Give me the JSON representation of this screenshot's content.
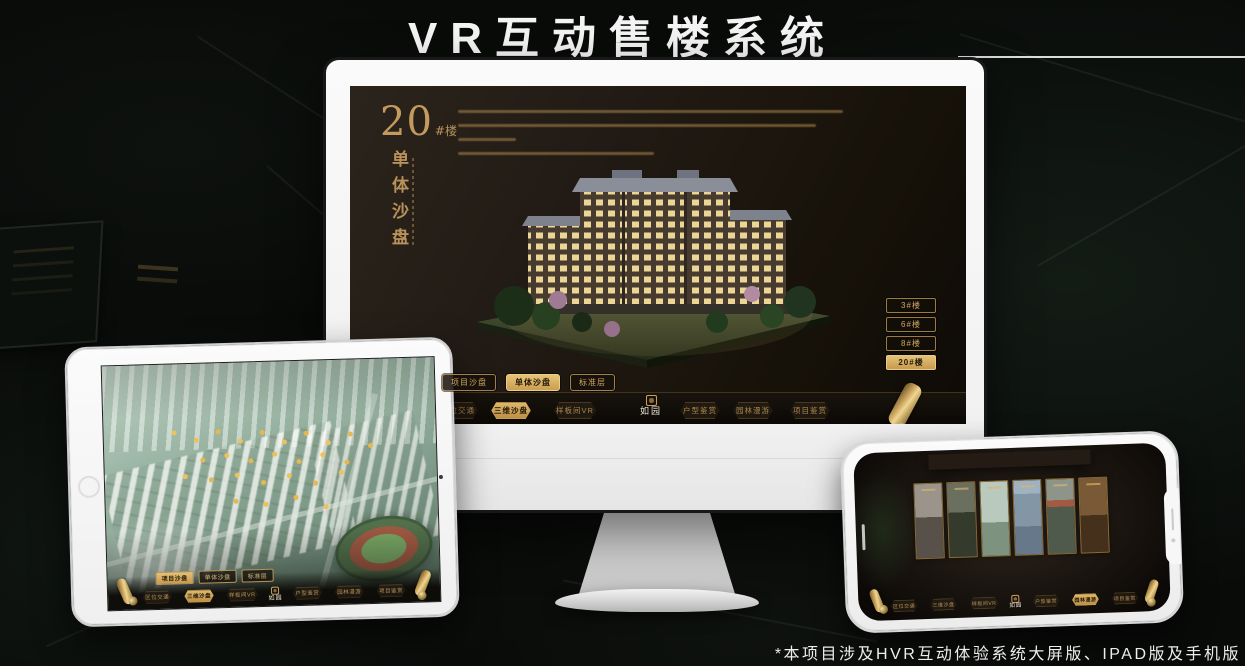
{
  "page": {
    "title": "VR互动售楼系统",
    "footnote": "*本项目涉及HVR互动体验系统大屏版、IPAD版及手机版"
  },
  "colors": {
    "gold": "#c9a063",
    "gold_active": "#d9b15f",
    "screen_dark": "#171210",
    "background": "#090b09"
  },
  "monitor": {
    "headline": {
      "number": "20",
      "suffix": "#楼",
      "subtitle": "单体沙盘"
    },
    "floor_buttons": [
      {
        "label": "3#楼",
        "active": false
      },
      {
        "label": "6#楼",
        "active": false
      },
      {
        "label": "8#楼",
        "active": false
      },
      {
        "label": "20#楼",
        "active": true
      }
    ],
    "tabs": [
      {
        "label": "项目沙盘",
        "active": false
      },
      {
        "label": "单体沙盘",
        "active": true
      },
      {
        "label": "标准层",
        "active": false
      }
    ],
    "nav": {
      "logo": "如园",
      "items": [
        {
          "label": "区位交通",
          "active": false
        },
        {
          "label": "三维沙盘",
          "active": true
        },
        {
          "label": "样板间VR",
          "active": false
        },
        {
          "label": "户型鉴赏",
          "active": false
        },
        {
          "label": "园林漫游",
          "active": false
        },
        {
          "label": "项目鉴赏",
          "active": false
        }
      ]
    }
  },
  "tablet": {
    "tabs": [
      {
        "label": "项目沙盘",
        "active": true
      },
      {
        "label": "单体沙盘",
        "active": false
      },
      {
        "label": "标准层",
        "active": false
      }
    ],
    "nav": {
      "logo": "如园",
      "items": [
        {
          "label": "区位交通",
          "active": false
        },
        {
          "label": "三维沙盘",
          "active": true
        },
        {
          "label": "样板间VR",
          "active": false
        },
        {
          "label": "户型鉴赏",
          "active": false
        },
        {
          "label": "园林漫游",
          "active": false
        },
        {
          "label": "项目鉴赏",
          "active": false
        }
      ]
    }
  },
  "phone": {
    "nav": {
      "logo": "如园",
      "items": [
        {
          "label": "区位交通",
          "active": false
        },
        {
          "label": "三维沙盘",
          "active": false
        },
        {
          "label": "样板间VR",
          "active": false
        },
        {
          "label": "户型鉴赏",
          "active": false
        },
        {
          "label": "园林漫游",
          "active": true
        },
        {
          "label": "项目鉴赏",
          "active": false
        }
      ]
    }
  }
}
